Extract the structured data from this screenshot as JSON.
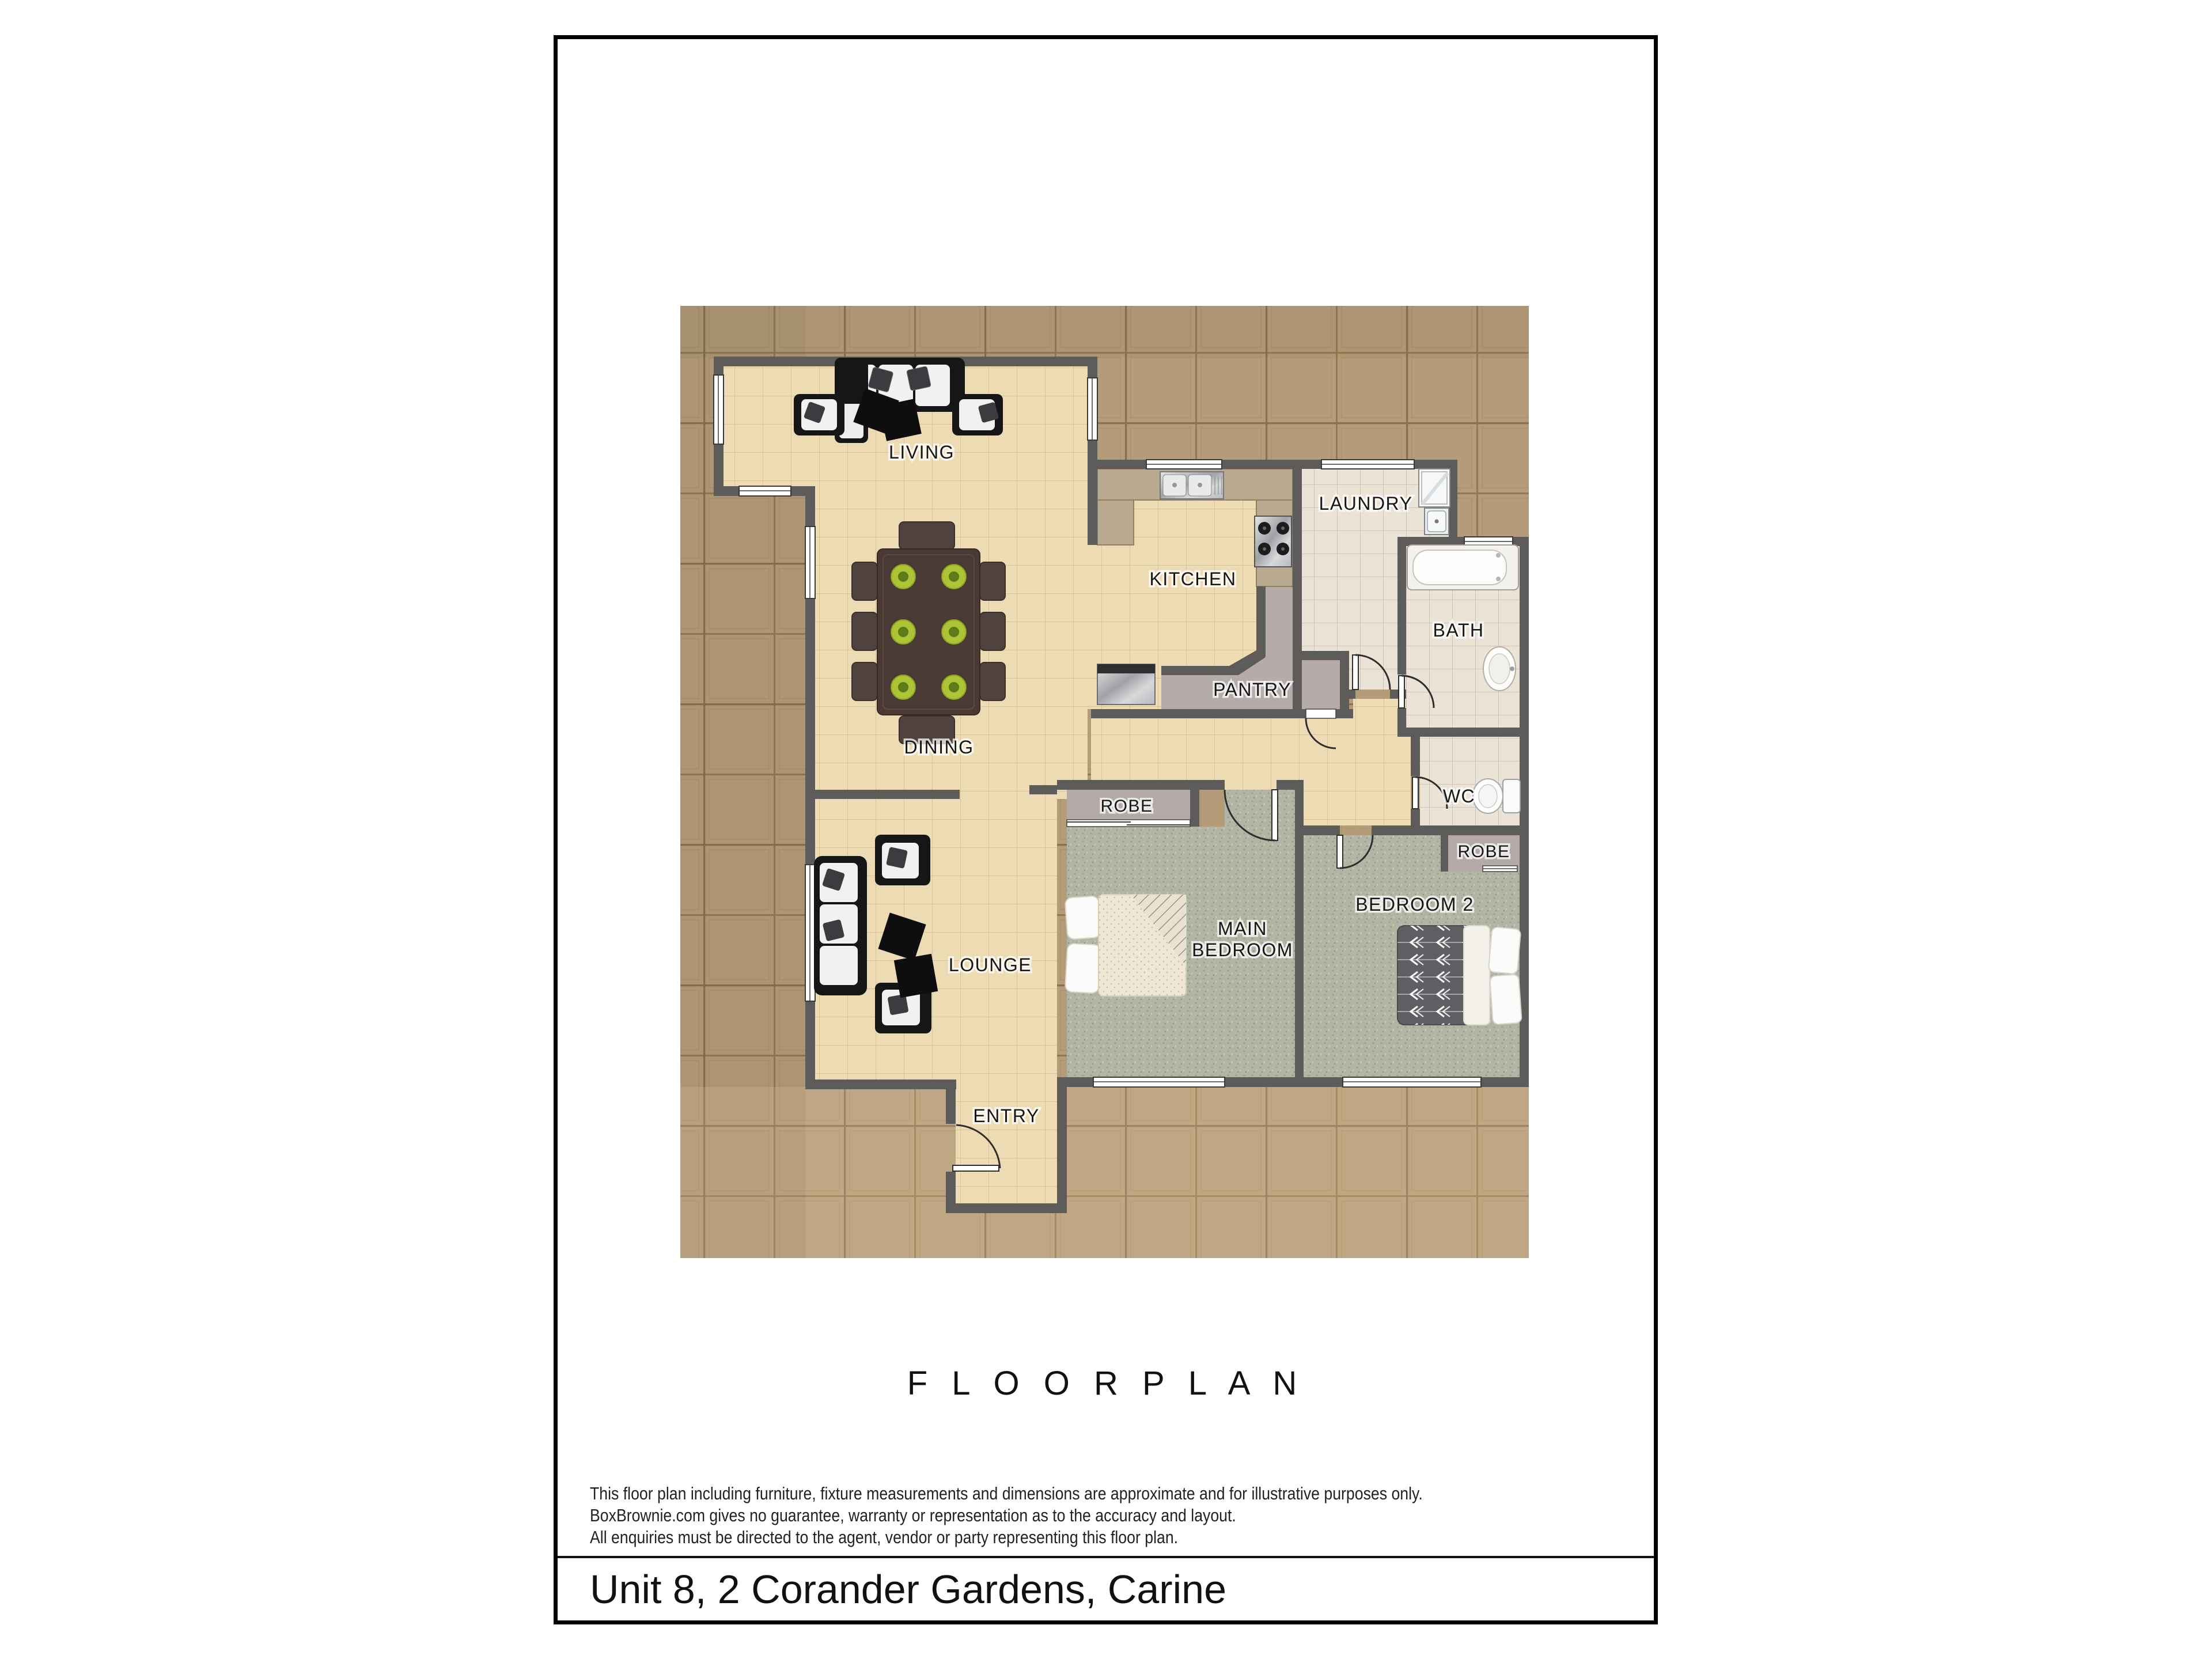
{
  "floor_plan": {
    "title": "F L O O R   P L A N",
    "address": "Unit 8, 2 Corander Gardens, Carine",
    "disclaimer_lines": [
      "This floor plan including furniture, fixture measurements and dimensions are approximate and for illustrative purposes only.",
      "BoxBrownie.com gives no guarantee, warranty or representation as to the accuracy and layout.",
      "All enquiries must be directed to the agent, vendor or party representing this floor plan."
    ],
    "rooms": {
      "living": {
        "label": "LIVING"
      },
      "kitchen": {
        "label": "KITCHEN"
      },
      "laundry": {
        "label": "LAUNDRY"
      },
      "bath": {
        "label": "BATH"
      },
      "pantry": {
        "label": "PANTRY"
      },
      "dining": {
        "label": "DINING"
      },
      "lounge": {
        "label": "LOUNGE"
      },
      "entry": {
        "label": "ENTRY"
      },
      "main_bedroom": {
        "line1": "MAIN",
        "line2": "BEDROOM"
      },
      "bedroom2": {
        "label": "BEDROOM 2"
      },
      "wc": {
        "label": "WC"
      },
      "robe_main": {
        "label": "ROBE"
      },
      "robe_bedroom2": {
        "label": "ROBE"
      }
    },
    "colors": {
      "page_border": "#000000",
      "wall": "#5e5b5b",
      "paver": "#b59c79",
      "paver_grout": "#937953",
      "floor_tile": "#eddbb4",
      "wet_tile": "#ebe4d6",
      "carpet": "#b2b4a4",
      "pantry_gray": "#b5acaa",
      "counter_tan": "#b9a98f",
      "furniture_black": "#161617",
      "furniture_white": "#f2f1ef",
      "table_brown": "#4a3a33",
      "plate_green": "#aec437",
      "duvet_gray": "#5d5f62"
    }
  }
}
